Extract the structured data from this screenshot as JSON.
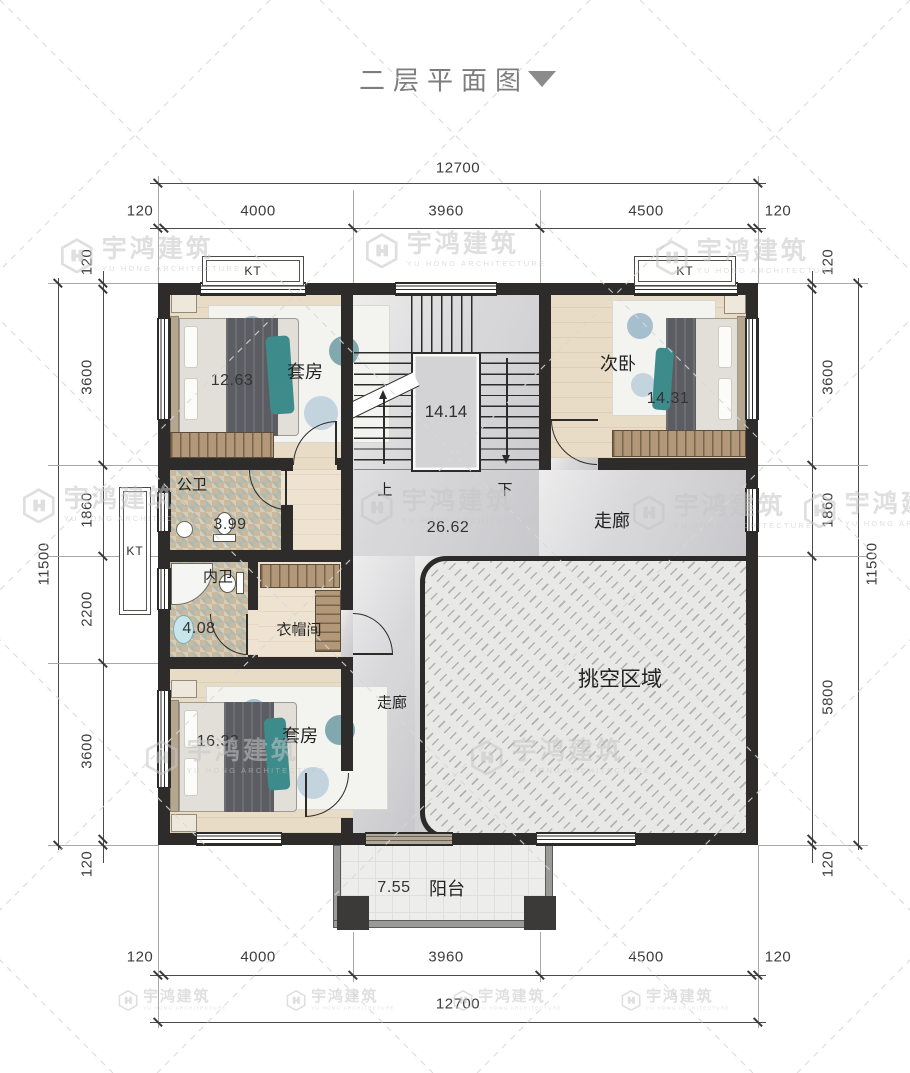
{
  "title": {
    "text": "二层平面图"
  },
  "watermark": {
    "brand": "宇鸿建筑",
    "subtitle": "YU HONG ARCHITECTURE"
  },
  "dims": {
    "top": {
      "total": "12700",
      "segs": [
        "120",
        "4000",
        "3960",
        "4500",
        "120"
      ]
    },
    "bottom": {
      "total": "12700",
      "segs": [
        "120",
        "4000",
        "3960",
        "4500",
        "120"
      ]
    },
    "left": {
      "total": "11500",
      "segs": [
        "120",
        "3600",
        "1860",
        "2200",
        "3600",
        "120"
      ]
    },
    "right": {
      "total": "11500",
      "segs": [
        "120",
        "3600",
        "1860",
        "5800",
        "120"
      ]
    }
  },
  "rooms": {
    "suite_top": {
      "name": "套房",
      "area": "12.63"
    },
    "stairwell": {
      "area": "14.14",
      "up": "上",
      "down": "下"
    },
    "bedroom2": {
      "name": "次卧",
      "area": "14.31"
    },
    "public_bath": {
      "name": "公卫",
      "area": "3.99"
    },
    "hall": {
      "name": "走廊",
      "area": "26.62"
    },
    "ensuite_bath": {
      "name": "内卫",
      "area": "4.08"
    },
    "cloakroom": {
      "name": "衣帽间"
    },
    "corridor": {
      "name": "走廊"
    },
    "void": {
      "name": "挑空区域"
    },
    "suite_bottom": {
      "name": "套房",
      "area": "16.33"
    },
    "balcony": {
      "name": "阳台",
      "area": "7.55"
    }
  },
  "labels": {
    "ac_platform": "KT"
  },
  "colors": {
    "wall": "#2d2c2a",
    "wood": "#e9dcc6",
    "marble": "#d7d7d9",
    "teal_accent": "#3e8b8c",
    "watermark": "#c6c6c6"
  }
}
